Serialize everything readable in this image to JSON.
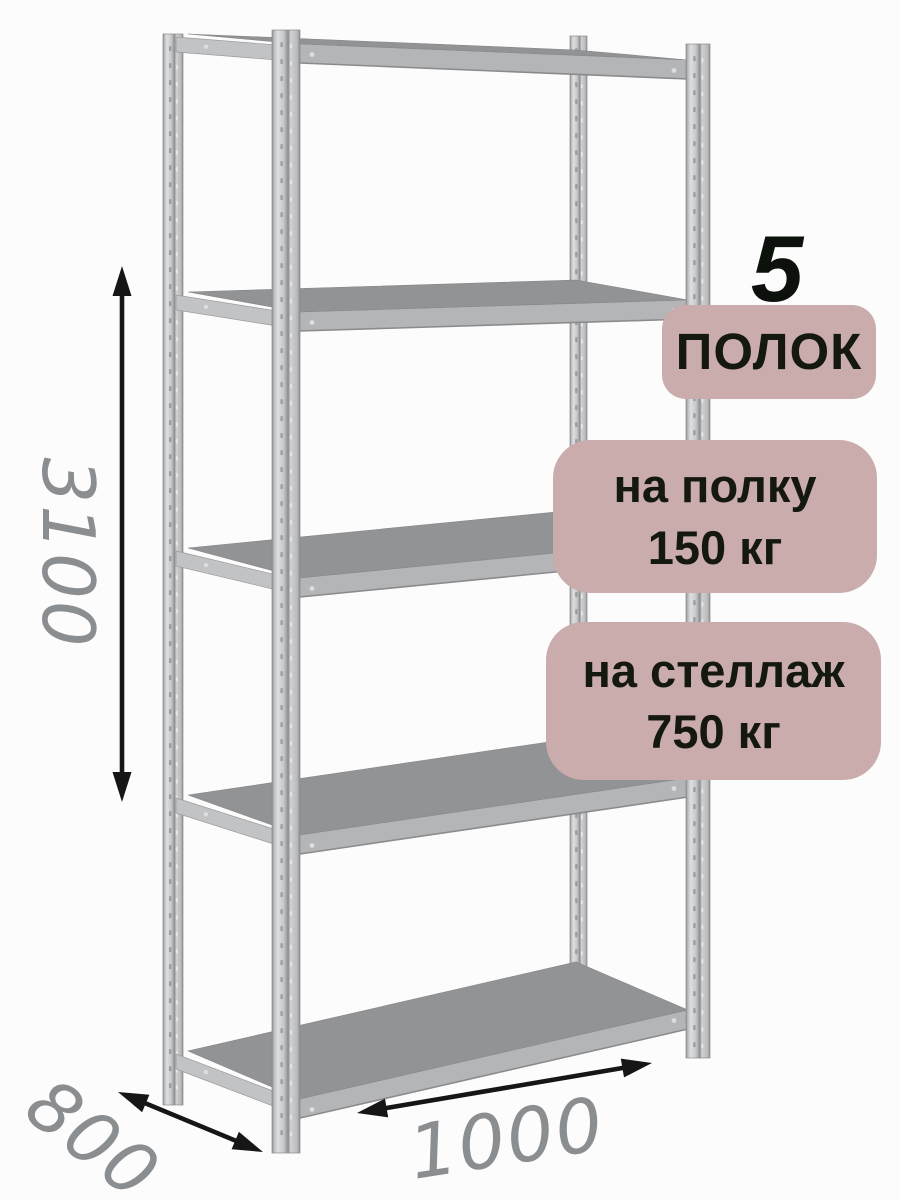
{
  "page": {
    "background": "#fcfcfc",
    "width": 900,
    "height": 1200
  },
  "annotations": {
    "shelf_count_number": "5",
    "shelf_count_label": "ПОЛОК",
    "shelf_load_line1": "на полку",
    "shelf_load_line2": "150 кг",
    "rack_load_line1": "на стеллаж",
    "rack_load_line2": "750 кг",
    "badge_bg": "#c9acab",
    "badge_text_color": "#14180f",
    "count_color": "#0d110c"
  },
  "dimensions": {
    "height_label": "3100",
    "depth_label": "800",
    "width_label": "1000",
    "label_color": "#8b8e90",
    "arrow_color": "#161616"
  },
  "rack": {
    "shelves": 5,
    "colors": {
      "surface": "#929395",
      "surface_edge": "#85868a",
      "fascia": "#b4b5b7",
      "fascia_edge": "#8a8b8d",
      "bracket": "#c2c3c5",
      "bracket_edge": "#9a9b9d",
      "post_light": "#dedfe1",
      "post_mid": "#c6c7c9",
      "post_soft": "#b9babc",
      "post_shade": "#a3a4a6",
      "post_edge": "#8b8c8e",
      "hole_dark": "#97989a",
      "hole_light": "#e8e9eb",
      "rivet": "#dcdddf"
    }
  }
}
